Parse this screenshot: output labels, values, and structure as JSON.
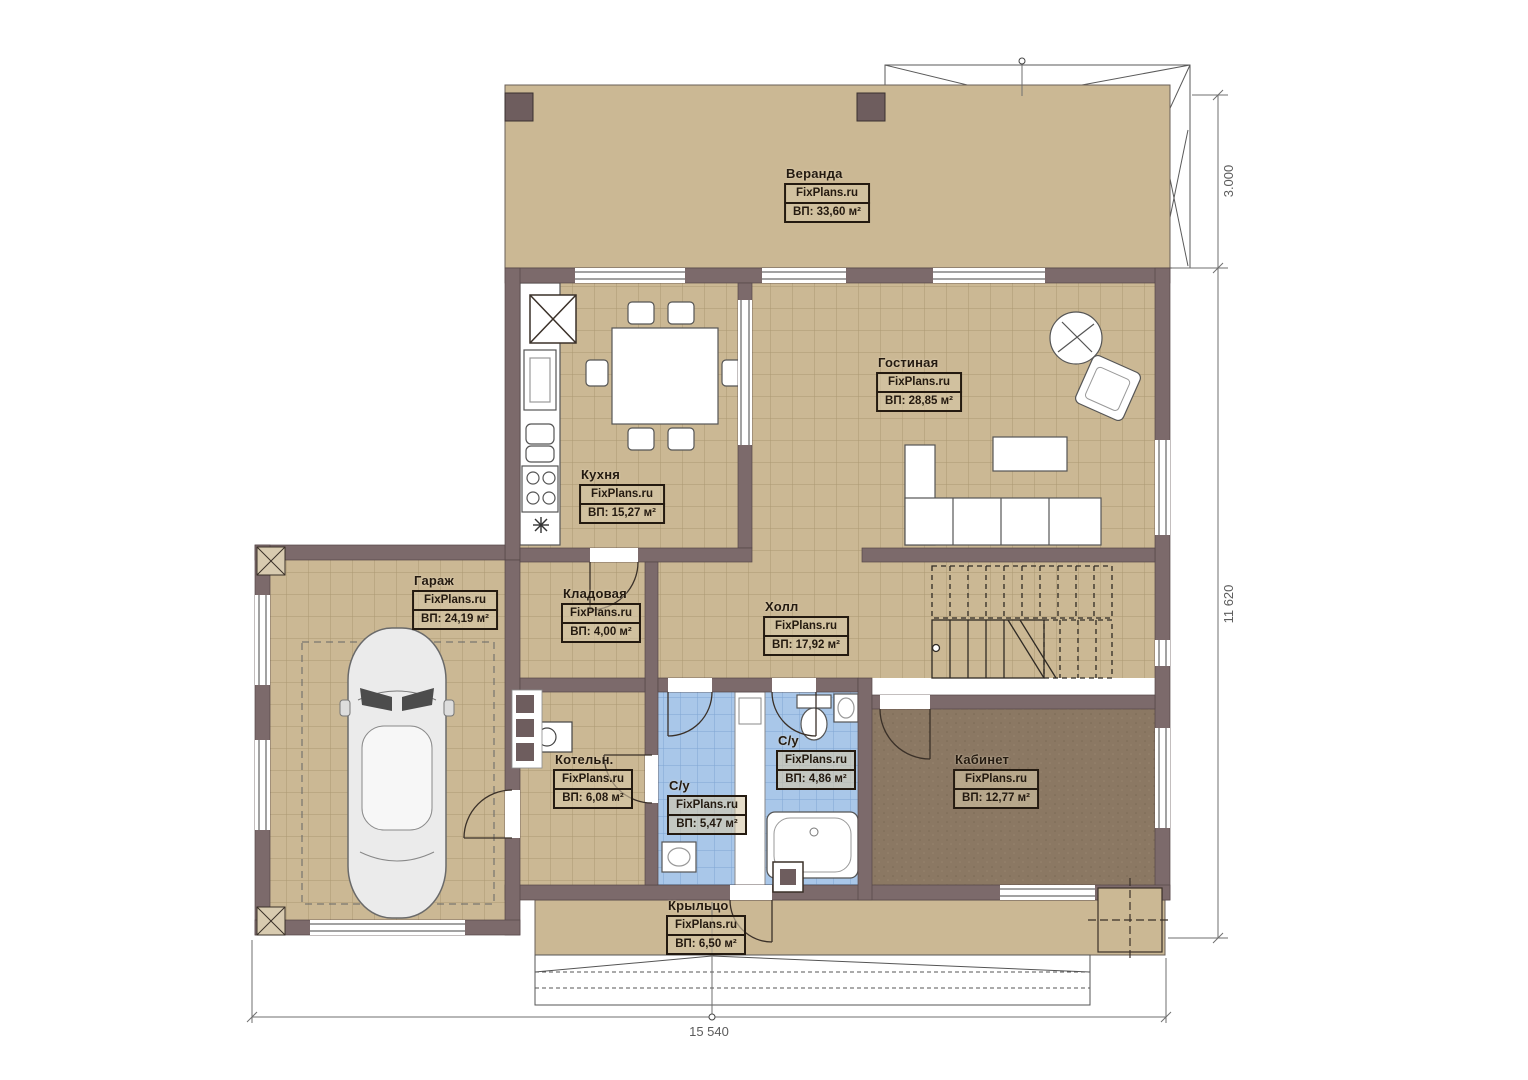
{
  "site_watermark": "FixPlans.ru",
  "rooms": [
    {
      "name": "Веранда",
      "watermark": "FixPlans.ru",
      "area": "ВП: 33,60 м²"
    },
    {
      "name": "Гостиная",
      "watermark": "FixPlans.ru",
      "area": "ВП: 28,85 м²"
    },
    {
      "name": "Кухня",
      "watermark": "FixPlans.ru",
      "area": "ВП: 15,27 м²"
    },
    {
      "name": "Гараж",
      "watermark": "FixPlans.ru",
      "area": "ВП: 24,19 м²"
    },
    {
      "name": "Кладовая",
      "watermark": "FixPlans.ru",
      "area": "ВП: 4,00 м²"
    },
    {
      "name": "Холл",
      "watermark": "FixPlans.ru",
      "area": "ВП: 17,92 м²"
    },
    {
      "name": "Котельн.",
      "watermark": "FixPlans.ru",
      "area": "ВП: 6,08 м²"
    },
    {
      "name": "С/у",
      "watermark": "FixPlans.ru",
      "area": "ВП: 5,47 м²"
    },
    {
      "name": "С/у",
      "watermark": "FixPlans.ru",
      "area": "ВП: 4,86 м²"
    },
    {
      "name": "Кабинет",
      "watermark": "FixPlans.ru",
      "area": "ВП: 12,77 м²"
    },
    {
      "name": "Крыльцо",
      "watermark": "FixPlans.ru",
      "area": "ВП: 6,50 м²"
    }
  ],
  "dimensions": {
    "veranda_depth": "3.000",
    "total_height": "11 620",
    "total_width": "15 540"
  },
  "colors": {
    "wall": "#7c6a6b",
    "floor_tan": "#cbb894",
    "floor_tile_grid": "#ab9872",
    "floor_blue": "#a9c7e9",
    "floor_blue_grid": "#7fa6d3",
    "floor_office": "#8b7863",
    "line_dark": "#3a3028",
    "dimension_line": "#6f6f6f"
  }
}
